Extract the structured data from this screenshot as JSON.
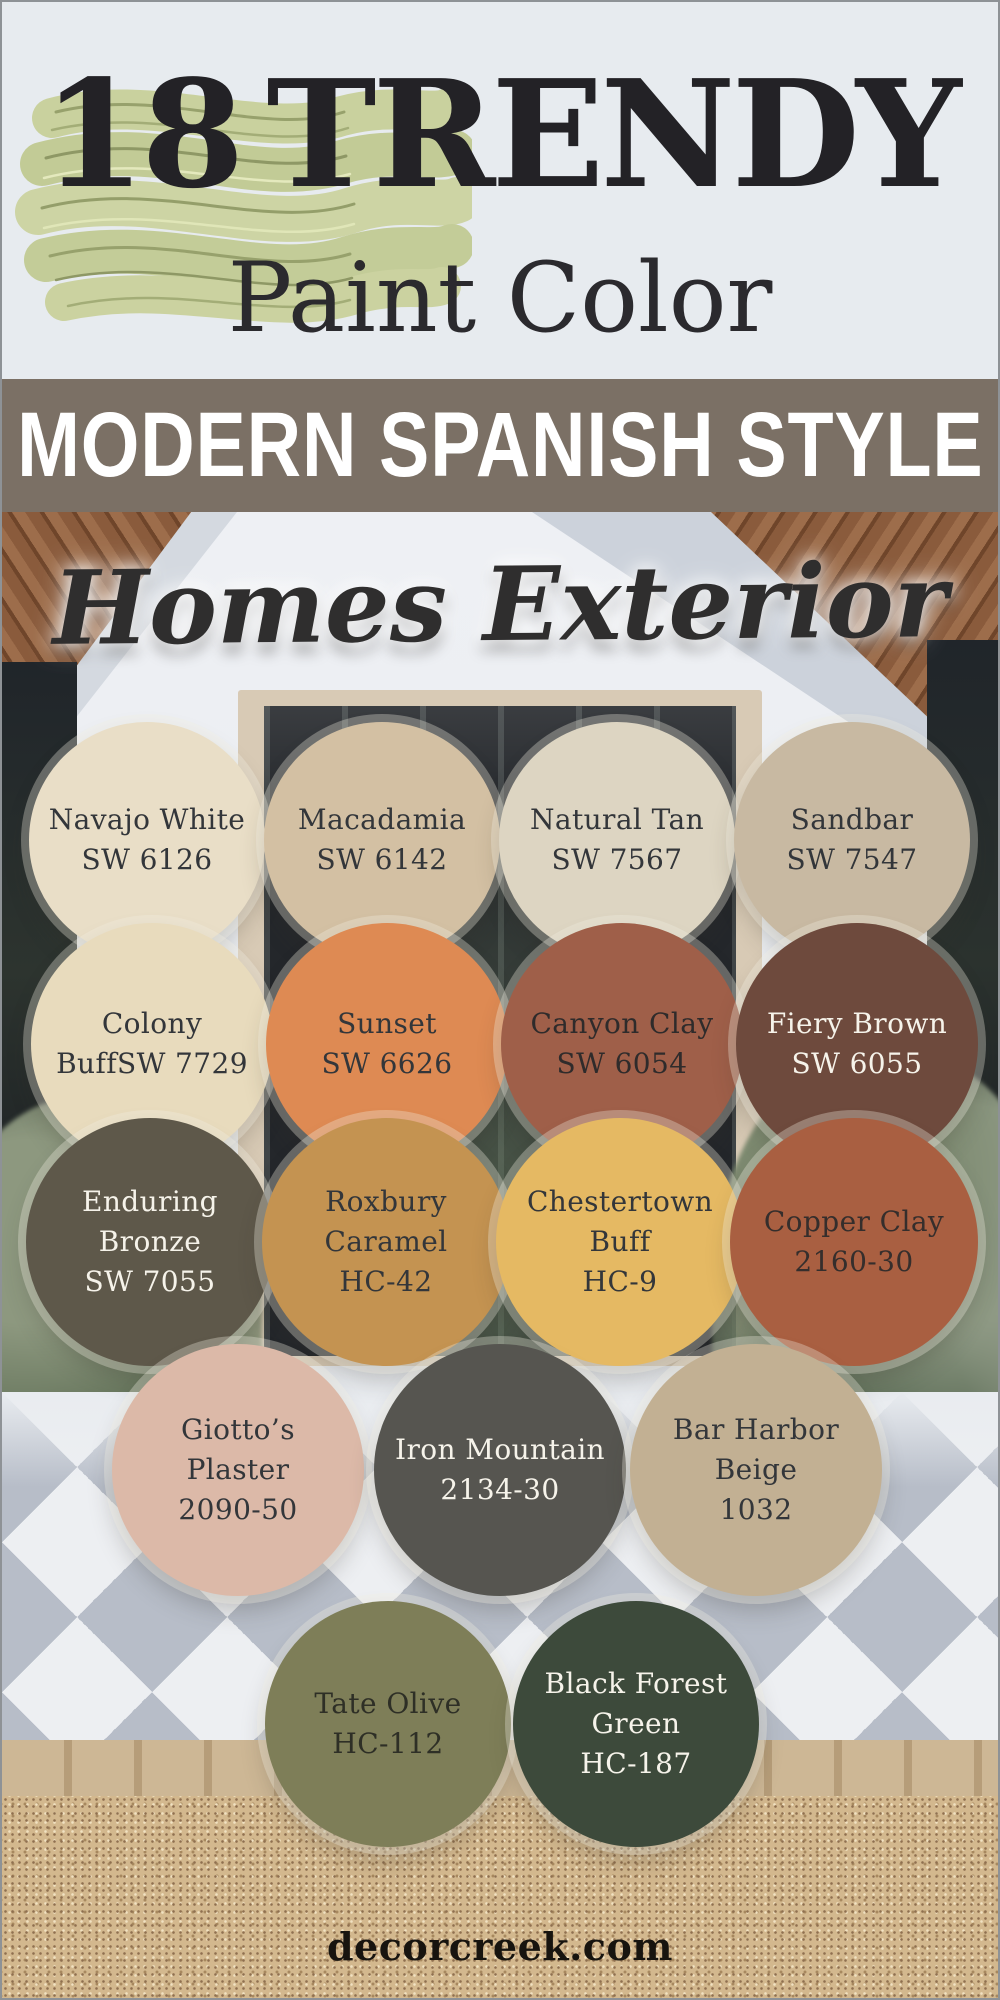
{
  "header": {
    "count": "18",
    "title": "TRENDY",
    "subtitle": "Paint Color",
    "text_color": "#232226",
    "background": "#e7ebef",
    "paint_stroke_color": "#c7cf9b"
  },
  "banner": {
    "label": "MODERN SPANISH STYLE",
    "background": "#7b7065",
    "text_color": "#ffffff"
  },
  "photo": {
    "script_title": "Homes Exterior",
    "script_color": "#2f2e2e"
  },
  "swatches": [
    {
      "name": "Navajo White",
      "code": "SW 6126",
      "lines": [
        "Navajo White",
        "SW 6126"
      ],
      "color": "#e9dec7",
      "text_color": "#33363a",
      "row": 1
    },
    {
      "name": "Macadamia",
      "code": "SW 6142",
      "lines": [
        "Macadamia",
        "SW 6142"
      ],
      "color": "#d3c0a3",
      "text_color": "#33363a",
      "row": 1
    },
    {
      "name": "Natural Tan",
      "code": "SW 7567",
      "lines": [
        "Natural Tan",
        "SW 7567"
      ],
      "color": "#ddd5c2",
      "text_color": "#33363a",
      "row": 1
    },
    {
      "name": "Sandbar",
      "code": "SW 7547",
      "lines": [
        "Sandbar",
        "SW 7547"
      ],
      "color": "#c8b9a2",
      "text_color": "#33363a",
      "row": 1
    },
    {
      "name": "Colony Buff",
      "code": "SW 7729",
      "lines": [
        "Colony",
        "BuffSW 7729"
      ],
      "color": "#e8dbbd",
      "text_color": "#33363a",
      "row": 2
    },
    {
      "name": "Sunset",
      "code": "SW 6626",
      "lines": [
        "Sunset",
        "SW 6626"
      ],
      "color": "#de8a53",
      "text_color": "#33363a",
      "row": 2
    },
    {
      "name": "Canyon Clay",
      "code": "SW 6054",
      "lines": [
        "Canyon Clay",
        "SW 6054"
      ],
      "color": "#9f5f49",
      "text_color": "#2f2b2b",
      "row": 2
    },
    {
      "name": "Fiery Brown",
      "code": "SW 6055",
      "lines": [
        "Fiery Brown",
        "SW 6055"
      ],
      "color": "#6e4a3d",
      "text_color": "#f6f3ea",
      "row": 2
    },
    {
      "name": "Enduring Bronze",
      "code": "SW 7055",
      "lines": [
        "Enduring",
        "Bronze",
        "SW 7055"
      ],
      "color": "#5e584a",
      "text_color": "#f6f3ea",
      "row": 3
    },
    {
      "name": "Roxbury Caramel",
      "code": "HC-42",
      "lines": [
        "Roxbury",
        "Caramel",
        "HC-42"
      ],
      "color": "#c49351",
      "text_color": "#33363a",
      "row": 3
    },
    {
      "name": "Chestertown Buff",
      "code": "HC-9",
      "lines": [
        "Chestertown",
        "Buff",
        "HC-9"
      ],
      "color": "#e5b963",
      "text_color": "#33363a",
      "row": 3
    },
    {
      "name": "Copper Clay",
      "code": "2160-30",
      "lines": [
        "Copper Clay",
        "2160-30"
      ],
      "color": "#a95f41",
      "text_color": "#352e2c",
      "row": 3
    },
    {
      "name": "Giotto’s Plaster",
      "code": "2090-50",
      "lines": [
        "Giotto’s",
        "Plaster",
        "2090-50"
      ],
      "color": "#dcb9a8",
      "text_color": "#33363a",
      "row": 4
    },
    {
      "name": "Iron Mountain",
      "code": "2134-30",
      "lines": [
        "Iron Mountain",
        "2134-30"
      ],
      "color": "#565550",
      "text_color": "#f6f3ea",
      "row": 4
    },
    {
      "name": "Bar Harbor Beige",
      "code": "1032",
      "lines": [
        "Bar Harbor",
        "Beige",
        "1032"
      ],
      "color": "#c2b093",
      "text_color": "#33363a",
      "row": 4
    },
    {
      "name": "Tate Olive",
      "code": "HC-112",
      "lines": [
        "Tate Olive",
        "HC-112"
      ],
      "color": "#7e7e58",
      "text_color": "#2e2f26",
      "row": 5
    },
    {
      "name": "Black Forest Green",
      "code": "HC-187",
      "lines": [
        "Black Forest",
        "Green",
        "HC-187"
      ],
      "color": "#3d4a3b",
      "text_color": "#f6f3ea",
      "row": 5
    }
  ],
  "footer": {
    "site": "decorcreek.com",
    "text_color": "#17140f"
  }
}
